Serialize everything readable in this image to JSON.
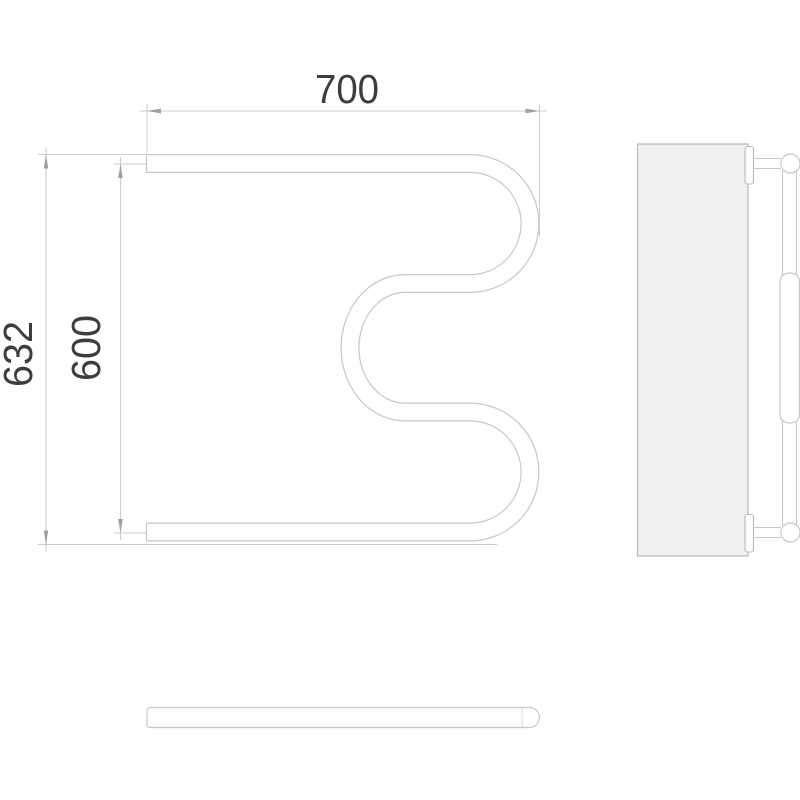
{
  "drawing": {
    "dimensions": {
      "width_mm": {
        "label": "700"
      },
      "overall_height_mm": {
        "label": "632"
      },
      "center_height_mm": {
        "label": "600"
      }
    },
    "colors": {
      "background": "#ffffff",
      "outline": "#c7c7c7",
      "dimension_line": "#cdcdcd",
      "arrow": "#a0a0a0",
      "text": "#3d3d3d",
      "wall_fill": "#f0f0f0",
      "wall_stroke": "#b9b9b9"
    }
  }
}
